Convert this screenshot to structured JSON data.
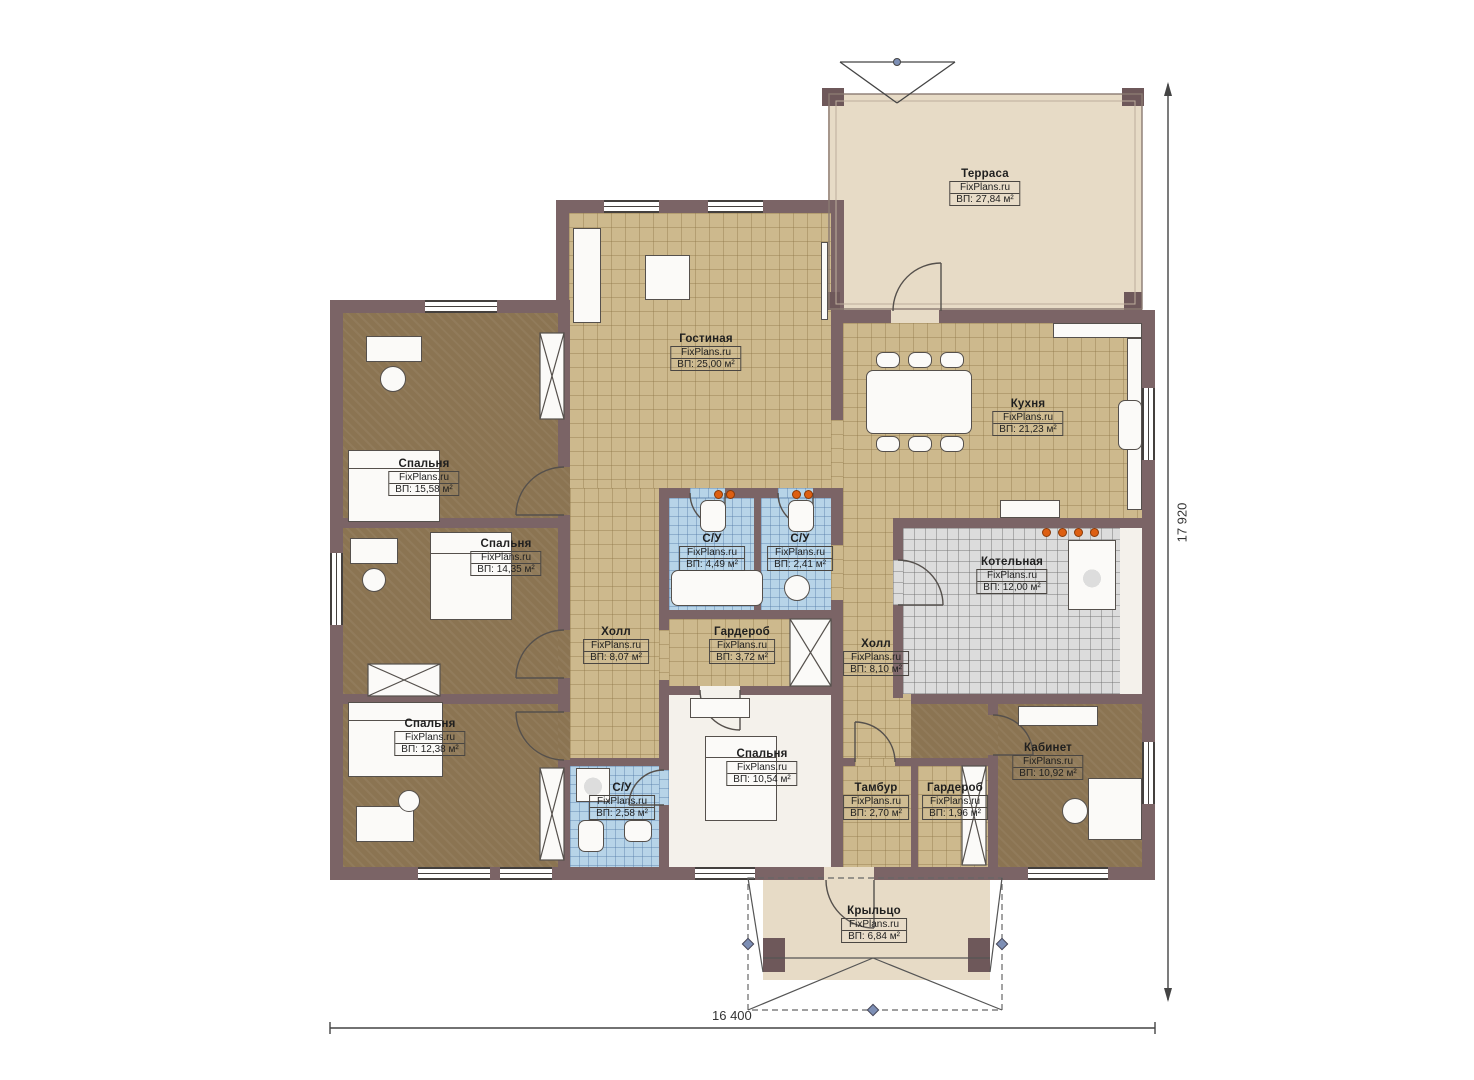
{
  "plan": {
    "watermark": "FixPlans.ru",
    "rooms": [
      {
        "id": "terrace",
        "name": "Терраса",
        "area": "ВП: 27,84 м²"
      },
      {
        "id": "living",
        "name": "Гостиная",
        "area": "ВП: 25,00 м²"
      },
      {
        "id": "kitchen",
        "name": "Кухня",
        "area": "ВП: 21,23 м²"
      },
      {
        "id": "bedroom1",
        "name": "Спальня",
        "area": "ВП: 15,58 м²"
      },
      {
        "id": "bedroom2",
        "name": "Спальня",
        "area": "ВП: 14,35 м²"
      },
      {
        "id": "bath1",
        "name": "С/У",
        "area": "ВП: 4,49 м²"
      },
      {
        "id": "bath2",
        "name": "С/У",
        "area": "ВП: 2,41 м²"
      },
      {
        "id": "boiler",
        "name": "Котельная",
        "area": "ВП: 12,00 м²"
      },
      {
        "id": "hall1",
        "name": "Холл",
        "area": "ВП: 8,07 м²"
      },
      {
        "id": "wardrobe1",
        "name": "Гардероб",
        "area": "ВП: 3,72 м²"
      },
      {
        "id": "hall2",
        "name": "Холл",
        "area": "ВП: 8,10 м²"
      },
      {
        "id": "bedroom3",
        "name": "Спальня",
        "area": "ВП: 12,38 м²"
      },
      {
        "id": "bath3",
        "name": "С/У",
        "area": "ВП: 2,58 м²"
      },
      {
        "id": "bedroom4",
        "name": "Спальня",
        "area": "ВП: 10,54 м²"
      },
      {
        "id": "tambour",
        "name": "Тамбур",
        "area": "ВП: 2,70 м²"
      },
      {
        "id": "wardrobe2",
        "name": "Гардероб",
        "area": "ВП: 1,96 м²"
      },
      {
        "id": "cabinet",
        "name": "Кабинет",
        "area": "ВП: 10,92 м²"
      },
      {
        "id": "porch",
        "name": "Крыльцо",
        "area": "ВП: 6,84 м²"
      }
    ],
    "dimensions": {
      "width": "16 400",
      "height": "17 920"
    },
    "colors": {
      "wall": "#7b6466",
      "floor_tan": "#cdb98d",
      "floor_brown": "#8b7452",
      "floor_blue": "#b7d4e8",
      "floor_gray": "#dcdcdc",
      "floor_cream": "#e7dbc6",
      "accent_dots": "#dd5f12"
    }
  }
}
